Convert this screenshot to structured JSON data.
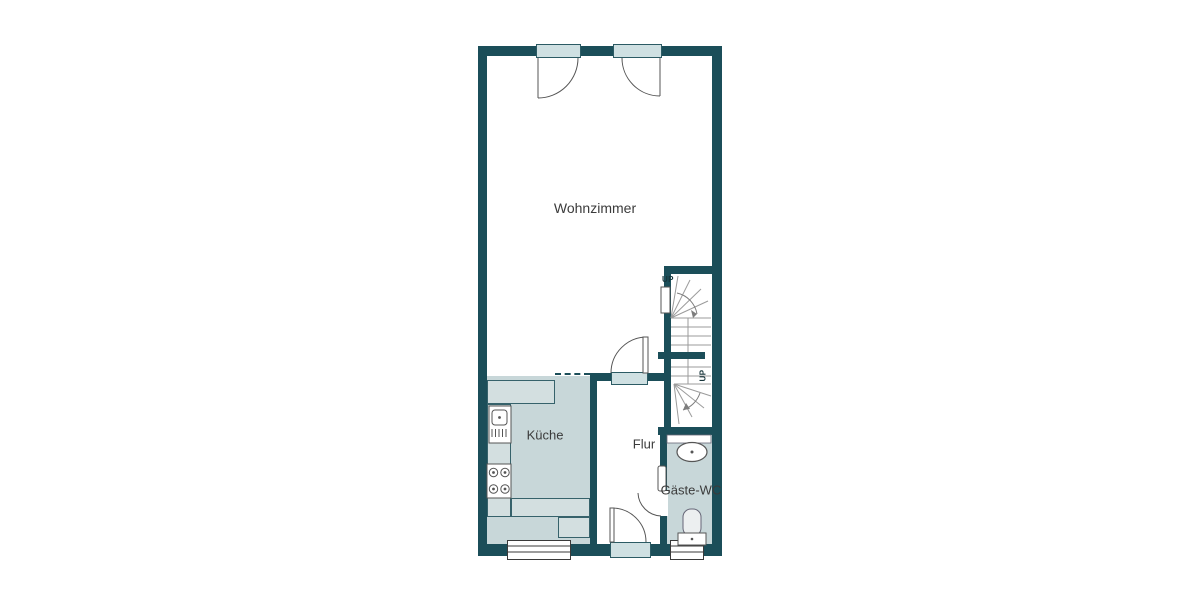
{
  "plan": {
    "title": "floor-plan-ground-floor",
    "rooms": [
      {
        "id": "wohnzimmer",
        "label": "Wohnzimmer"
      },
      {
        "id": "kueche",
        "label": "Küche"
      },
      {
        "id": "flur",
        "label": "Flur"
      },
      {
        "id": "gaeste_wc",
        "label": "Gäste-WC"
      }
    ],
    "stairs": {
      "upper_direction_label": "UP",
      "lower_direction_label": "UP"
    },
    "fixtures": [
      "kitchen-sink",
      "stove",
      "washbasin",
      "toilet"
    ],
    "openings": {
      "french_doors_top": 2,
      "entrance_door_bottom": 1,
      "interior_doors": 2,
      "windows_bottom": 2
    },
    "colors": {
      "wall": "#1b4e59",
      "room_fill": "#c8d7d9",
      "counter_fill": "#d3dfe0",
      "door_panel_fill": "#cfe0e2",
      "stair_line": "#9b9b9b",
      "text": "#3b3b3b",
      "background": "#ffffff"
    }
  }
}
